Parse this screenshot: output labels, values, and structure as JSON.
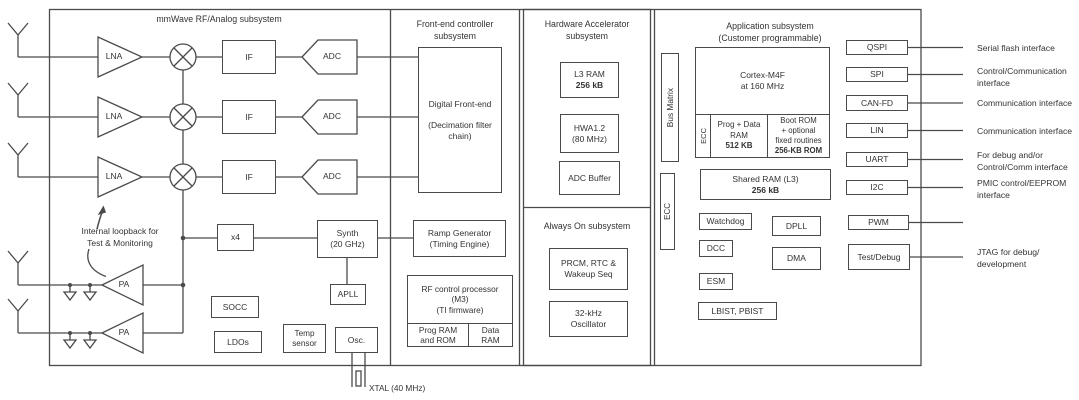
{
  "style": {
    "ink": "#4a4a4a",
    "text": "#333333",
    "background": "#ffffff"
  },
  "subsystems": {
    "mmwave": {
      "title": "mmWave RF/Analog subsystem"
    },
    "frontend": {
      "title_l1": "Front-end controller",
      "title_l2": "subsystem"
    },
    "hwa": {
      "title_l1": "Hardware Accelerator",
      "title_l2": "subsystem"
    },
    "alwayson": {
      "title": "Always On subsystem"
    },
    "app": {
      "title_l1": "Application subsystem",
      "title_l2": "(Customer programmable)"
    }
  },
  "rf": {
    "lna": "LNA",
    "if": "IF",
    "adc": "ADC",
    "pa": "PA",
    "loopback_l1": "Internal loopback for",
    "loopback_l2": "Test & Monitoring",
    "x4": "x4",
    "synth_l1": "Synth",
    "synth_l2": "(20 GHz)",
    "apll": "APLL",
    "socc": "SOCC",
    "ldos": "LDOs",
    "temp_l1": "Temp",
    "temp_l2": "sensor",
    "osc": "Osc.",
    "xtal": "XTAL (40 MHz)"
  },
  "frontend": {
    "dfe_l1": "Digital Front-end",
    "dfe_l2": "(Decimation filter",
    "dfe_l3": "chain)",
    "ramp_l1": "Ramp Generator",
    "ramp_l2": "(Timing Engine)",
    "rfproc_l1": "RF control processor",
    "rfproc_l2": "(M3)",
    "rfproc_l3": "(TI firmware)",
    "progrom_l1": "Prog RAM",
    "progrom_l2": "and ROM",
    "dataram_l1": "Data",
    "dataram_l2": "RAM"
  },
  "hwa": {
    "l3_l1": "L3 RAM",
    "l3_l2": "256 kB",
    "hwa_l1": "HWA1.2",
    "hwa_l2": "(80 MHz)",
    "adcbuf": "ADC Buffer"
  },
  "alwayson": {
    "prcm_l1": "PRCM, RTC &",
    "prcm_l2": "Wakeup Seq",
    "osc32_l1": "32-kHz",
    "osc32_l2": "Oscillator"
  },
  "app": {
    "bus_matrix": "Bus Matrix",
    "ecc": "ECC",
    "cortex_l1": "Cortex-M4F",
    "cortex_l2": "at 160 MHz",
    "progdata_l1": "Prog + Data",
    "progdata_l2": "RAM",
    "progdata_l3": "512 KB",
    "bootrom_l1": "Boot ROM",
    "bootrom_l2": "+ optional",
    "bootrom_l3": "fixed routines",
    "bootrom_l4": "256-KB ROM",
    "shared_l1": "Shared RAM (L3)",
    "shared_l2": "256 kB",
    "watchdog": "Watchdog",
    "dcc": "DCC",
    "esm": "ESM",
    "lbist": "LBIST, PBIST",
    "dpll": "DPLL",
    "dma": "DMA"
  },
  "interfaces": {
    "qspi": {
      "label": "QSPI",
      "d1": "Serial flash interface"
    },
    "spi": {
      "label": "SPI",
      "d1": "Control/Communication",
      "d2": "interface"
    },
    "canfd": {
      "label": "CAN-FD",
      "d1": "Communication interface"
    },
    "lin": {
      "label": "LIN",
      "d1": "Communication interface"
    },
    "uart": {
      "label": "UART",
      "d1": "For debug and/or",
      "d2": "Control/Comm interface"
    },
    "i2c": {
      "label": "I2C",
      "d1": "PMIC control/EEPROM",
      "d2": "interface"
    },
    "pwm": {
      "label": "PWM"
    },
    "testdebug": {
      "label": "Test/Debug",
      "d1": "JTAG for debug/",
      "d2": "development"
    }
  }
}
